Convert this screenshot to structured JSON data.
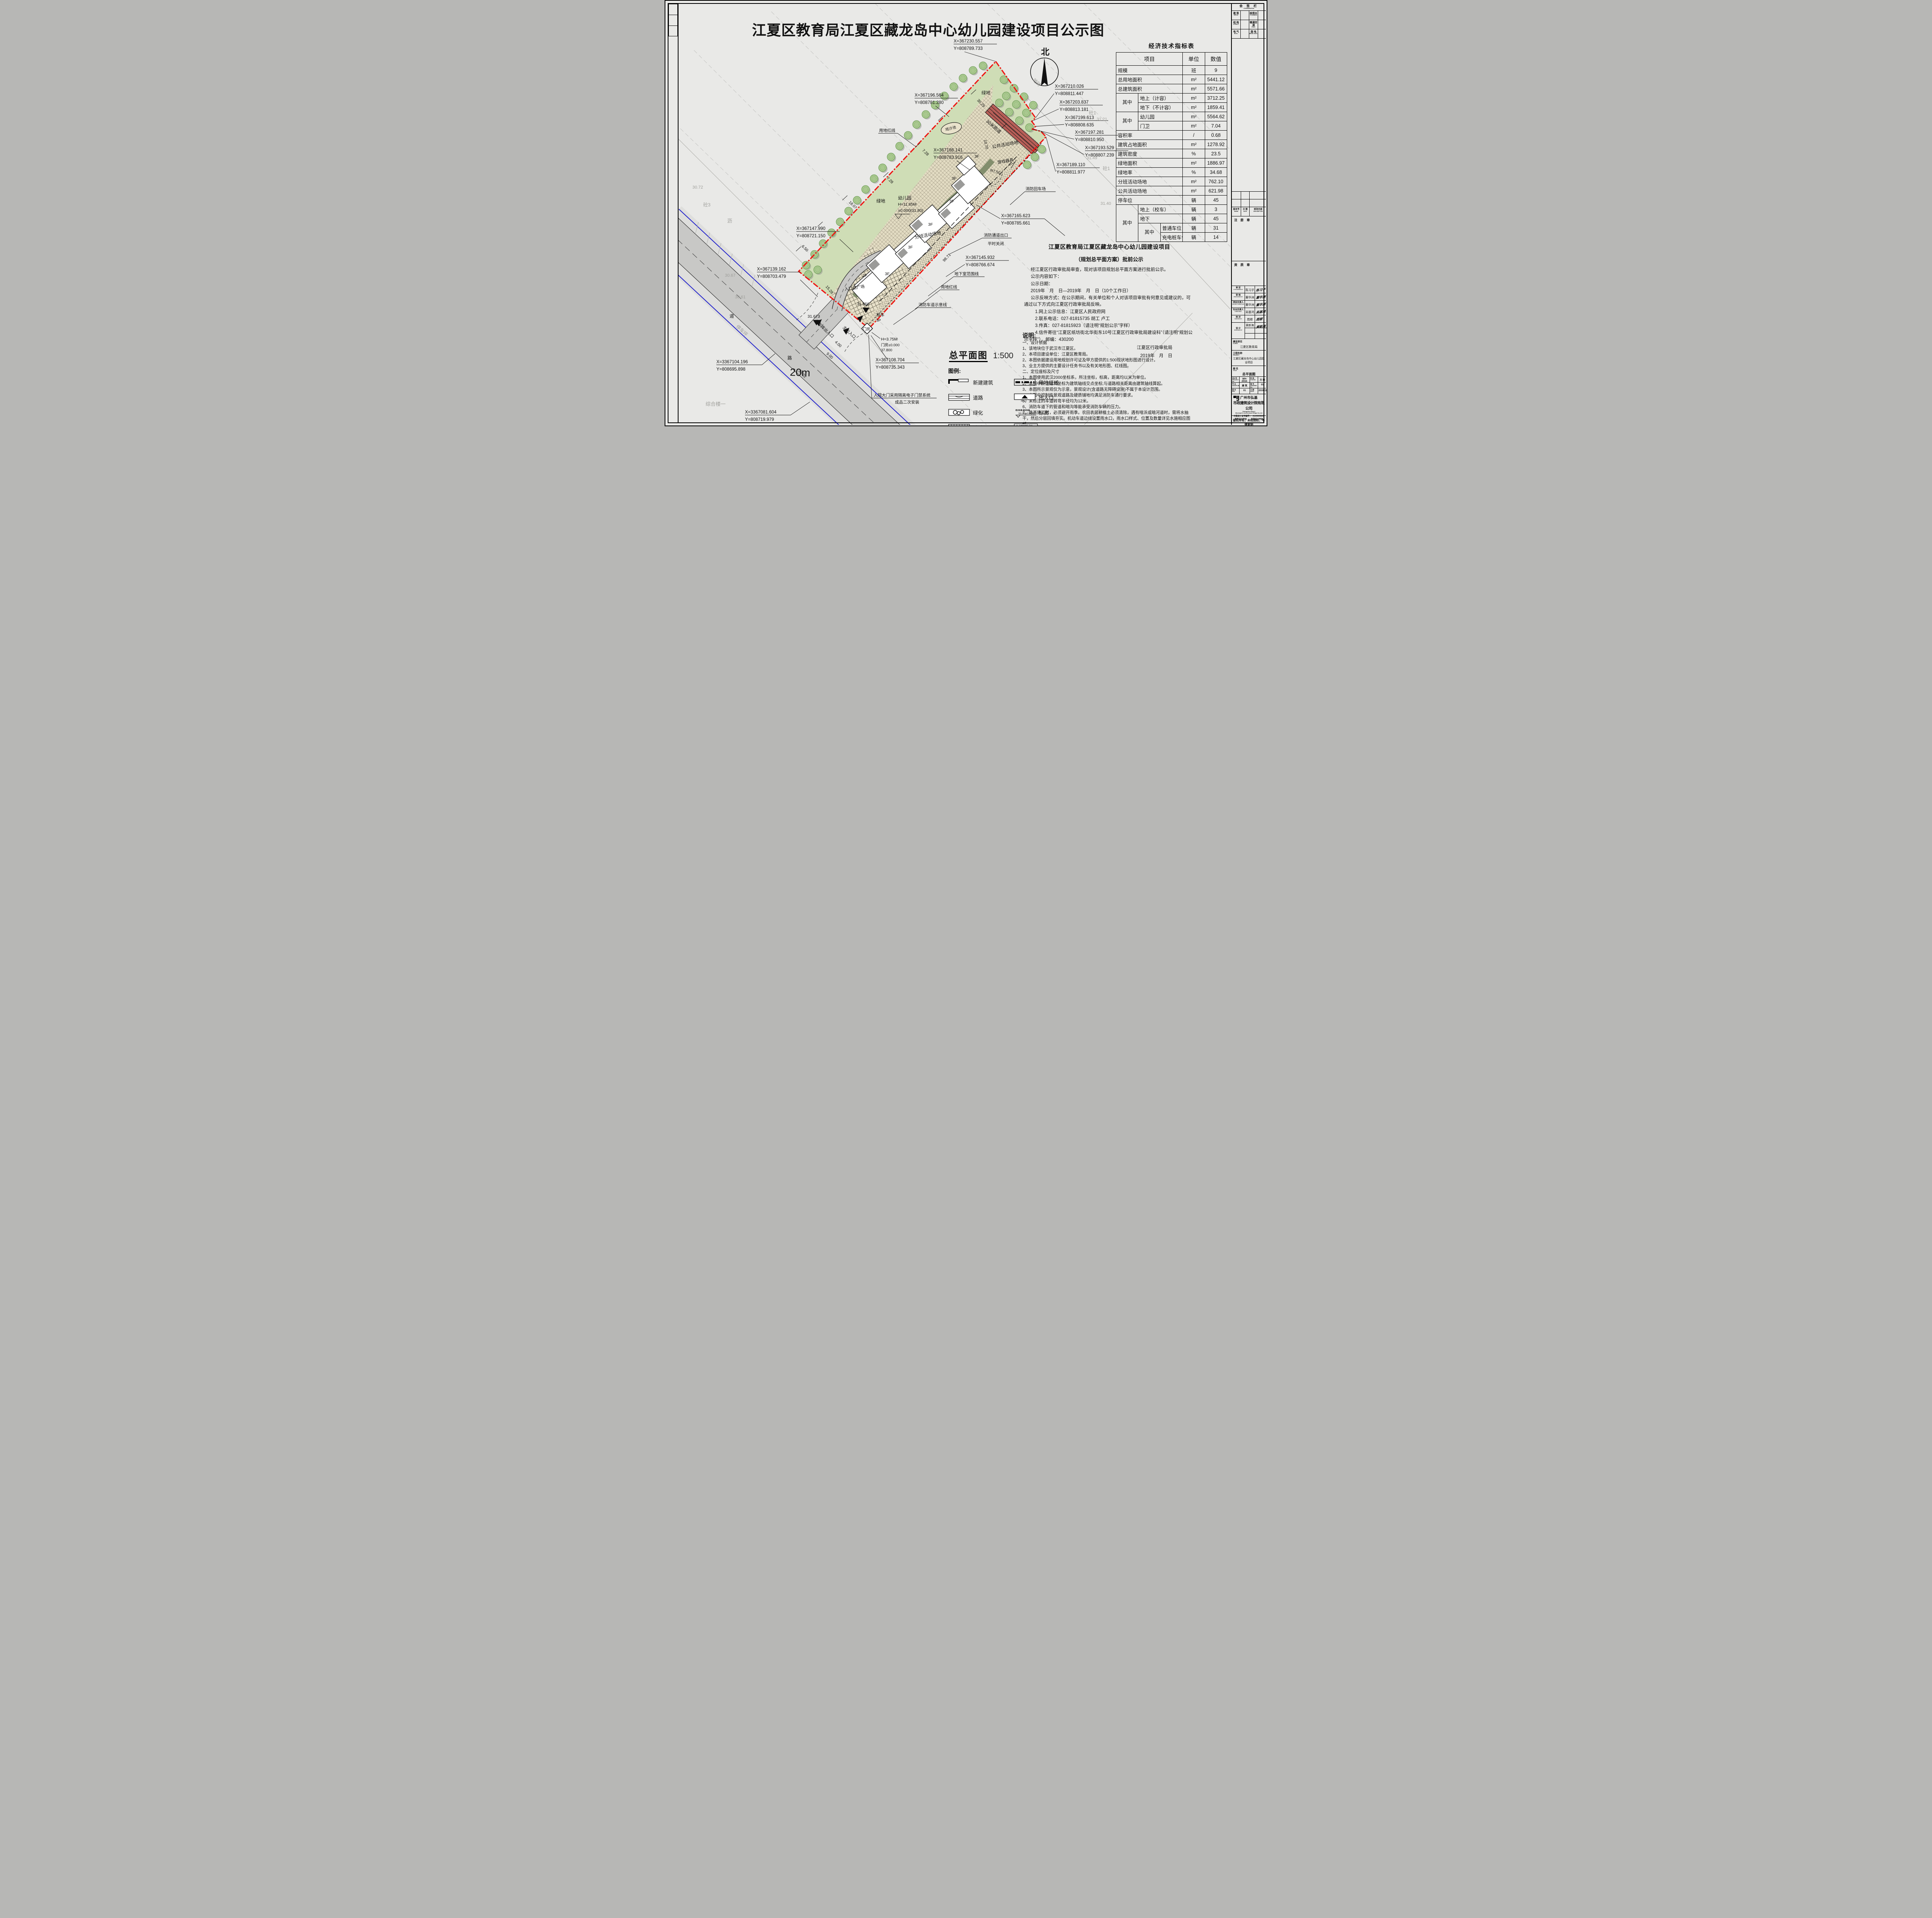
{
  "sheet": {
    "title": "江夏区教育局江夏区藏龙岛中心幼儿园建设项目公示图",
    "plan_title": "总平面图",
    "plan_scale": "1:500"
  },
  "table": {
    "title": "经济技术指标表",
    "headers": [
      "项目",
      "单位",
      "数值"
    ],
    "group_label": "其中",
    "rows": [
      {
        "label": "规模",
        "unit": "班",
        "value": "9"
      },
      {
        "label": "总用地面积",
        "unit": "m²",
        "value": "5441.12"
      },
      {
        "label": "总建筑面积",
        "unit": "m²",
        "value": "5571.66"
      },
      {
        "label": "地上（计容）",
        "unit": "m²",
        "value": "3712.25"
      },
      {
        "label": "地下（不计容）",
        "unit": "m²",
        "value": "1859.41"
      },
      {
        "label": "幼儿园",
        "unit": "m²",
        "value": "5564.62"
      },
      {
        "label": "门卫",
        "unit": "m²",
        "value": "7.04"
      },
      {
        "label": "容积率",
        "unit": "/",
        "value": "0.68"
      },
      {
        "label": "建筑占地面积",
        "unit": "m²",
        "value": "1278.92"
      },
      {
        "label": "建筑密度",
        "unit": "%",
        "value": "23.5"
      },
      {
        "label": "绿地面积",
        "unit": "m²",
        "value": "1886.97"
      },
      {
        "label": "绿地率",
        "unit": "%",
        "value": "34.68"
      },
      {
        "label": "分班活动场地",
        "unit": "m²",
        "value": "762.10"
      },
      {
        "label": "公共活动场地",
        "unit": "m²",
        "value": "621.98"
      },
      {
        "label": "停车位",
        "unit": "辆",
        "value": "45"
      },
      {
        "label": "地上（校车）",
        "unit": "辆",
        "value": "3"
      },
      {
        "label": "地下",
        "unit": "辆",
        "value": "45"
      },
      {
        "label": "普通车位",
        "unit": "辆",
        "value": "31"
      },
      {
        "label": "充电桩车位",
        "unit": "辆",
        "value": "14"
      }
    ]
  },
  "notice": {
    "title1": "江夏区教育局江夏区藏龙岛中心幼儿园建设项目",
    "title2": "（规划总平面方案）批前公示",
    "lines": [
      "经江夏区行政审批局审查，现对该项目规划总平面方案进行批前公示。",
      "公示内容如下：",
      "公示日期：",
      "2019年　月　日—2019年　月　日（10个工作日）",
      "公示反映方式：在公示期间，有关单位和个人对该项目审批有何意见或建议的，可通过以下方式向江夏区行政审批局反映。",
      "1.网上公示信息：江夏区人民政府网",
      "2.联系电话：027-81815735 胡工 卢工",
      "3.传真：027-81815923（请注明“规划公示”字样）",
      "4.信件寄往“江夏区纸坊街北华街东10号江夏区行政审批局建设科”（请注明“规划公示字样”），邮编：430200"
    ],
    "sign1": "江夏区行政审批局",
    "sign2": "2019年　月　日"
  },
  "notes": {
    "heading": "说明:",
    "lines": [
      "一、设计依据",
      "1、该地块位于武汉市江夏区。",
      "2、本项目建设单位：江夏区教育局。",
      "2、本图依据建设用地规划许可证及甲方提供的1:500现状地形图进行设计。",
      "3、业主方提供的主要设计任务书以及有关地形图、红线图。",
      "二、定位座标及尺寸",
      "1、本图使用武汉2000坐标系，所注坐标，标高，距离均以米为单位。",
      "2、本图中所注建筑坐标为建筑轴线交点坐标;与道路相关距离由建筑轴线算起。",
      "3、本图所示景观仅为示意，景观设计(含道路无障碍设施)不属于本设计范围。",
      "4、本图中控制性景观道路及硬质铺地均满足消防车通行要求。",
      "5、未标注的车道转弯半径均为12米。",
      "6、消防车道下的管道和暗沟等能承受消防车辆的压力。",
      "7、路基施工时，必须避开雨季。农田表层耕植土必须清除，遇有喑浜或暗河道时，需将水抽干，然后分层回填夯实。机动车道边线设置雨水口，雨水口样式、位置及数量详见水施相应图纸。",
      "8、本方案日照分析采用PKPM SunLight软件分析，幼儿园的主要生活用房，满足冬至日3小时日照标准(计算时间9;00-15:00)，建设单位及设计单位对日照结果真实性负责。",
      "9、本方案为坡屋顶和平屋面建筑，建筑高度的计算坡屋顶建筑物室外地面至其檐口高度加上屋脊的平均高度。平屋面为建筑物室外地坪至其女儿墙顶的高度。"
    ]
  },
  "legend": {
    "title": "图例:",
    "items": [
      "新建建筑",
      "道路",
      "绿化",
      "铺地",
      "用地红线",
      "出入口",
      "标高",
      "坐标"
    ],
    "exit_icon_text": "出入口",
    "level_head": "绝对标高  相对标高",
    "level_sample": "50.00(±0.000)",
    "coord_x": "X=3403295.741",
    "coord_y": "Y=39371322.902"
  },
  "plan": {
    "north": "北",
    "labels": {
      "green": "绿地",
      "sandpit": "戏沙池",
      "track": "30米跑道",
      "public_area": "公共活动场地",
      "play_equip": "游戏器具",
      "class_area": "分班活动场地",
      "kg1": "幼儿园",
      "kg2": "H=11.85M",
      "kg3": "±0.000(31.80)",
      "f3": "3F",
      "f2": "2F",
      "fire_turn": "消防回车场",
      "fire_exit1": "消防通道出口",
      "fire_exit2": "平时关闭",
      "basement_line": "地下室范围线",
      "redline": "用地红线",
      "fire_lane": "消防车道示意线",
      "plaza": "入口前广场",
      "bus": "校车",
      "bus_p": "3P",
      "gatehouse": "门房",
      "gate_h": "H=3.75M",
      "gate_e1": "门房±0.000",
      "gate_e2": "37.800",
      "garage_exit": "汽车库出入口",
      "main_exit": "主出入口",
      "gate_note1": "入院大门采用隔离电子门禁系统",
      "gate_note2": "成品二次安装",
      "road1": "道",
      "road2": "路",
      "road_w": "20m",
      "elev1": "31.673",
      "elev2": "31.650"
    },
    "dims": {
      "d3029": "30.29",
      "d728": "7.28",
      "d1807": "18.07",
      "d650": "6.50",
      "d1528": "15.28",
      "d9871": "98.71",
      "d1070": "10.70",
      "d3302": "33.02",
      "d900": "9.00",
      "d400": "4.00",
      "dr750": "R7.50"
    },
    "coords": [
      {
        "x": "X=367230.557",
        "y": "Y=808789.733"
      },
      {
        "x": "X=367210.026",
        "y": "Y=808811.447"
      },
      {
        "x": "X=367203.837",
        "y": "Y=808813.181"
      },
      {
        "x": "X=367199.613",
        "y": "Y=808808.635"
      },
      {
        "x": "X=367197.281",
        "y": "Y=808810.950"
      },
      {
        "x": "X=367193.529",
        "y": "Y=808807.239"
      },
      {
        "x": "X=367189.110",
        "y": "Y=808811.977"
      },
      {
        "x": "X=367196.564",
        "y": "Y=808781.280"
      },
      {
        "x": "X=367186.141",
        "y": "Y=808783.916"
      },
      {
        "x": "X=367147.990",
        "y": "Y=808721.150"
      },
      {
        "x": "X=367139.162",
        "y": "Y=808703.479"
      },
      {
        "x": "X=367165.623",
        "y": "Y=808785.661"
      },
      {
        "x": "X=367145.932",
        "y": "Y=808766.674"
      },
      {
        "x": "X=367108.704",
        "y": "Y=808735.343"
      },
      {
        "x": "X=3367104.196",
        "y": "Y=808695.898"
      },
      {
        "x": "X=3367081.604",
        "y": "Y=808719.979"
      }
    ],
    "bg": [
      "砼1",
      "砼1",
      "砼3",
      "沥",
      "地砖",
      "综合楼一",
      "停车坪",
      "30.72",
      "30.67",
      "30.61",
      "31.21",
      "31.49",
      "31.40"
    ]
  },
  "titleblock": {
    "coordination": {
      "zh": "会 签 栏",
      "en": "COORDINATION",
      "cells": [
        {
          "zh": "建 筑",
          "en": "ARCHI."
        },
        {
          "zh": "给排水",
          "en": "PLUMBING"
        },
        {
          "zh": "结 构",
          "en": "STRUCT."
        },
        {
          "zh": "暖通空调",
          "en": "HVAC"
        },
        {
          "zh": "电 气",
          "en": "ELEC."
        },
        {
          "zh": "弱 电",
          "en": "WEAK ELEC."
        }
      ]
    },
    "revision": {
      "mark_zh": "版本号",
      "mark_en": "MARK",
      "date_zh": "日 期",
      "date_en": "DATE",
      "desc_zh": "修改内容",
      "desc_en": "DESCRIPTION"
    },
    "stamp1": "注 册 章",
    "stamp2": "资 质 章",
    "signs": [
      {
        "zh": "审 定",
        "en": "AUTHORIZED BY",
        "name": "陈习子"
      },
      {
        "zh": "审 核",
        "en": "PROCESSED BY",
        "name": "董华洲"
      },
      {
        "zh": "项目负责人",
        "en": "PROJECT DIRECTOR",
        "name": "董华洲"
      },
      {
        "zh": "专业负责人",
        "en": "CHIEF ENGL",
        "name": "吴基鸿"
      },
      {
        "zh": "校 对",
        "en": "CHECKED BY",
        "name": "周顺"
      }
    ],
    "design": {
      "zh": "设 计",
      "en": "DESIGNED BY",
      "name": "黄新海"
    },
    "client": {
      "zh": "建设单位",
      "en": "CLIENT",
      "value": "江夏区教育局"
    },
    "project": {
      "zh": "工程名称",
      "en": "PROJECT",
      "value": "江夏区藏龙岛中心幼儿园建设项目"
    },
    "drawing": {
      "zh": "图 名",
      "en": "TITLE",
      "value": "总平面图"
    },
    "meta": {
      "no_zh": "设计号",
      "no_en": "PROJECT No.",
      "no_v": "WH-2018-069",
      "st_zh": "阶 段",
      "st_en": "STATUS",
      "st_v": "方 案",
      "di_zh": "专 业",
      "di_en": "DISCIPLINE",
      "di_v": "建 筑",
      "dn_zh": "图 号",
      "dn_en": "DRAWING No.",
      "dn_v": "01",
      "re_zh": "版 本",
      "re_en": "REV.",
      "re_v": "01",
      "da_zh": "日 期",
      "da_en": "DATE",
      "da_v": "2019.11"
    },
    "company": {
      "c1": "广州市弘基",
      "c2": "市政建筑设计院有限公司",
      "e1": "Guangzhou Hong ji",
      "e2": "Municipal & Architectural Design Co.,Ltd",
      "cert": "工程设计证书编号 ： A144009203",
      "grade1": "建筑设计甲级",
      "grade2": "市政设计甲级"
    },
    "copyright": "版权所有，未经授权，不得复制"
  }
}
